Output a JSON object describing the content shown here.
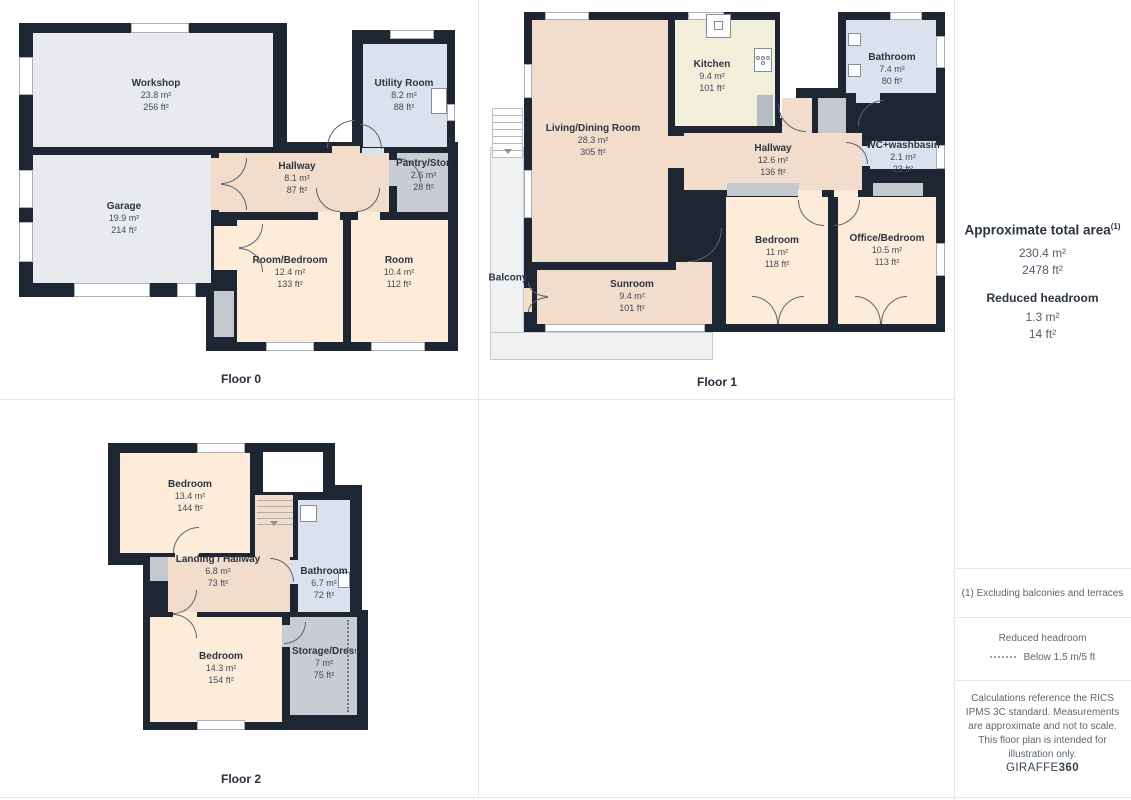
{
  "floors": [
    {
      "label": "Floor 0",
      "rooms": [
        {
          "name": "Workshop",
          "m2": "23.8 m²",
          "ft2": "256 ft²"
        },
        {
          "name": "Utility Room",
          "m2": "8.2 m²",
          "ft2": "88 ft²"
        },
        {
          "name": "Hallway",
          "m2": "8.1 m²",
          "ft2": "87 ft²"
        },
        {
          "name": "Pantry/Storage",
          "m2": "2.6 m²",
          "ft2": "28 ft²"
        },
        {
          "name": "Garage",
          "m2": "19.9 m²",
          "ft2": "214 ft²"
        },
        {
          "name": "Room/Bedroom",
          "m2": "12.4 m²",
          "ft2": "133 ft²"
        },
        {
          "name": "Room",
          "m2": "10.4 m²",
          "ft2": "112 ft²"
        }
      ]
    },
    {
      "label": "Floor 1",
      "rooms": [
        {
          "name": "Living/Dining Room",
          "m2": "28.3 m²",
          "ft2": "305 ft²"
        },
        {
          "name": "Kitchen",
          "m2": "9.4 m²",
          "ft2": "101 ft²"
        },
        {
          "name": "Bathroom",
          "m2": "7.4 m²",
          "ft2": "80 ft²"
        },
        {
          "name": "Hallway",
          "m2": "12.6 m²",
          "ft2": "136 ft²"
        },
        {
          "name": "WC+washbasin",
          "m2": "2.1 m²",
          "ft2": "23 ft²"
        },
        {
          "name": "Bedroom",
          "m2": "11 m²",
          "ft2": "118 ft²"
        },
        {
          "name": "Office/Bedroom",
          "m2": "10.5 m²",
          "ft2": "113 ft²"
        },
        {
          "name": "Sunroom",
          "m2": "9.4 m²",
          "ft2": "101 ft²"
        },
        {
          "name": "Balcony"
        }
      ]
    },
    {
      "label": "Floor 2",
      "rooms": [
        {
          "name": "Bedroom",
          "m2": "13.4 m²",
          "ft2": "144 ft²"
        },
        {
          "name": "Landing / Hallway",
          "m2": "6.8 m²",
          "ft2": "73 ft²"
        },
        {
          "name": "Bathroom",
          "m2": "6.7 m²",
          "ft2": "72 ft²"
        },
        {
          "name": "Bedroom",
          "m2": "14.3 m²",
          "ft2": "154 ft²"
        },
        {
          "name": "Storage/Dressing",
          "m2": "7 m²",
          "ft2": "75 ft²"
        }
      ]
    }
  ],
  "sidebar": {
    "total": {
      "heading": "Approximate total area",
      "sup": "(1)",
      "m2": "230.4 m²",
      "ft2": "2478 ft²"
    },
    "reduced": {
      "heading": "Reduced headroom",
      "m2": "1.3 m²",
      "ft2": "14 ft²"
    },
    "footnote": "(1) Excluding balconies and terraces",
    "legend": {
      "heading": "Reduced headroom",
      "label": "Below 1.5 m/5 ft"
    },
    "disclaimer": "Calculations reference the RICS IPMS 3C standard. Measurements are approximate and not to scale. This floor plan is intended for illustration only.",
    "brand": {
      "name": "GIRAFFE",
      "suffix": "360"
    }
  },
  "colors": {
    "wall": "#1e2633",
    "room_gray": "#e9eaed",
    "room_blue": "#dbe2ee",
    "room_pink": "#f2dccb",
    "room_peach": "#fdecd9",
    "room_cream": "#f1eed9",
    "storage_gray": "#c8cdd3",
    "divider": "#e4e7ea",
    "text": "#2b3544"
  }
}
